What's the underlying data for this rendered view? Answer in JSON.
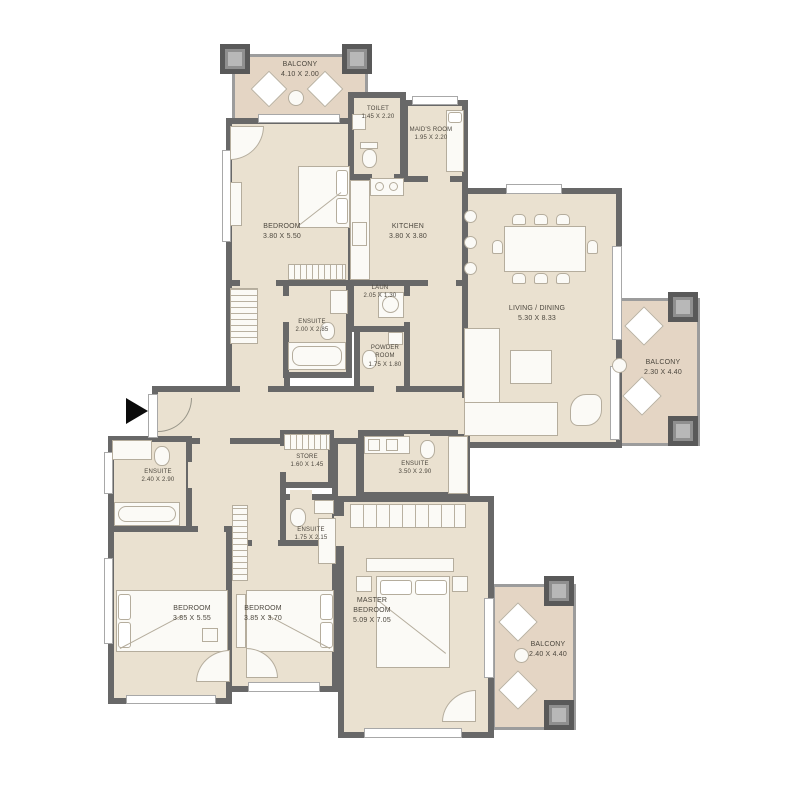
{
  "plan": {
    "rooms": {
      "balcony_top": {
        "name": "BALCONY",
        "dims": "4.10 X 2.00"
      },
      "toilet": {
        "name": "TOILET",
        "dims": "1.45 X 2.20"
      },
      "maids_room": {
        "name": "MAID'S ROOM",
        "dims": "1.95 X 2.20"
      },
      "bedroom_top": {
        "name": "BEDROOM",
        "dims": "3.80 X 5.50"
      },
      "kitchen": {
        "name": "KITCHEN",
        "dims": "3.80 X 3.80"
      },
      "laundry": {
        "name": "LAUN",
        "dims": "2.05 X 1.30"
      },
      "ensuite_top": {
        "name": "ENSUITE",
        "dims": "2.00 X 2.85"
      },
      "powder_room": {
        "name": "POWDER ROOM",
        "dims": "1.75 X 1.80"
      },
      "living_dining": {
        "name": "LIVING / DINING",
        "dims": "5.30 X 8.33"
      },
      "balcony_right": {
        "name": "BALCONY",
        "dims": "2.30 X 4.40"
      },
      "ensuite_left": {
        "name": "ENSUITE",
        "dims": "2.40 X 2.90"
      },
      "store": {
        "name": "STORE",
        "dims": "1.60 X 1.45"
      },
      "ensuite_mid": {
        "name": "ENSUITE",
        "dims": "1.75 X 2.15"
      },
      "ensuite_master": {
        "name": "ENSUITE",
        "dims": "3.50 X 2.90"
      },
      "bedroom_left": {
        "name": "BEDROOM",
        "dims": "3.85 X 5.55"
      },
      "bedroom_mid": {
        "name": "BEDROOM",
        "dims": "3.85 X 3.70"
      },
      "master_bedroom": {
        "name": "MASTER BEDROOM",
        "dims": "5.09 X 7.05"
      },
      "balcony_bottom": {
        "name": "BALCONY",
        "dims": "2.40 X 4.40"
      }
    },
    "icons": {
      "entry_marker": "right-arrow"
    },
    "colors": {
      "floor": "#eae1d0",
      "balcony": "#e4d5c4",
      "wall": "#686868",
      "wall_light": "#9c9c9c",
      "outline": "#b5ad9d",
      "text": "#4c473e",
      "arrow": "#0b0b0b"
    }
  }
}
